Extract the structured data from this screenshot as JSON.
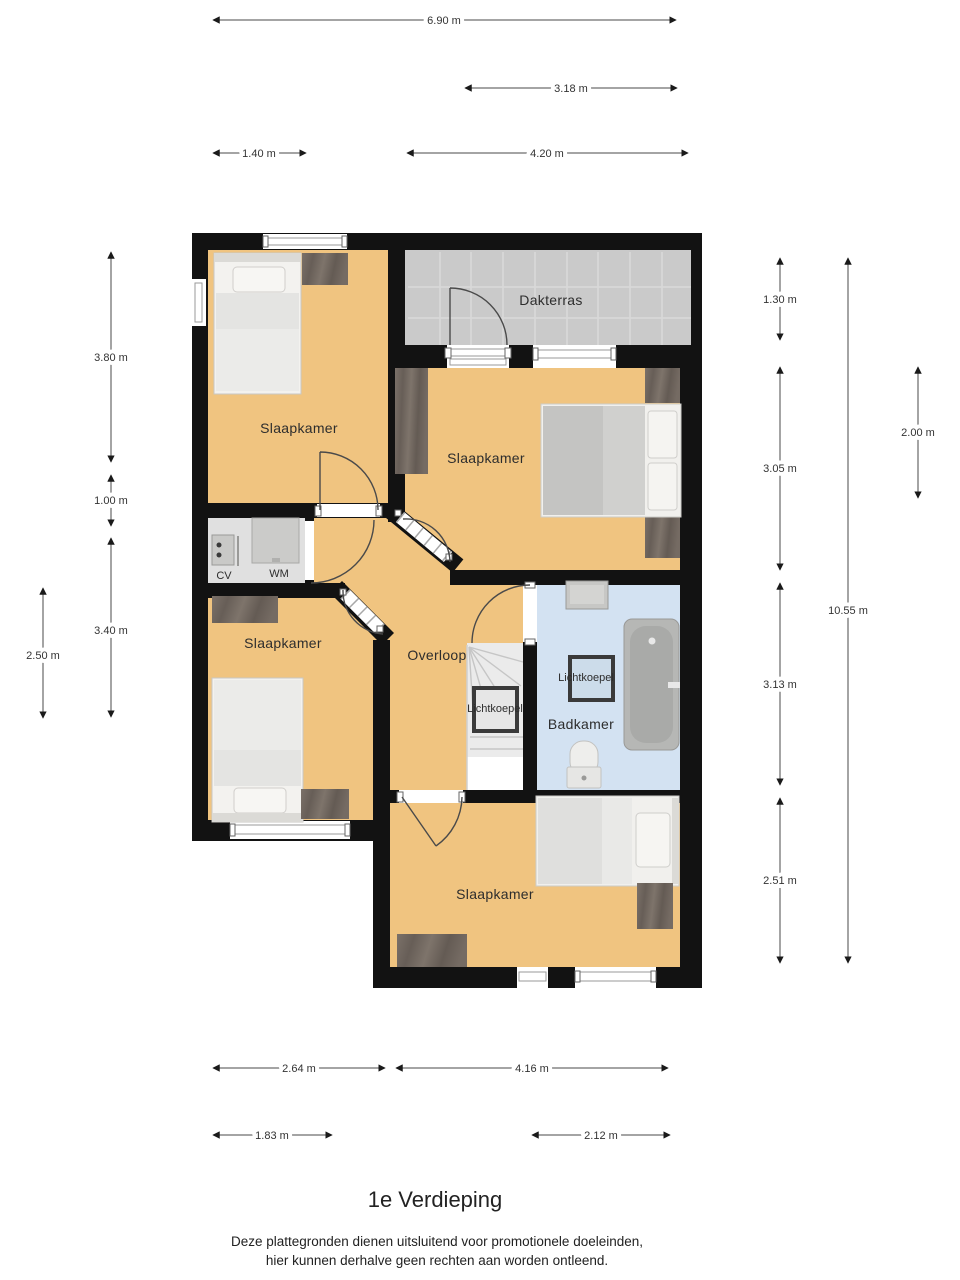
{
  "title": "1e Verdieping",
  "disclaimer": {
    "line1": "Deze plattegronden dienen uitsluitend voor promotionele doeleinden,",
    "line2": "hier kunnen derhalve geen rechten aan worden ontleend."
  },
  "rooms": {
    "bedroom_top_left": "Slaapkamer",
    "terrace": "Dakterras",
    "bedroom_right": "Slaapkamer",
    "bedroom_mid_left": "Slaapkamer",
    "landing": "Overloop",
    "bathroom": "Badkamer",
    "bedroom_bottom": "Slaapkamer",
    "skylight_stairs": "Lichtkoepel",
    "skylight_bathroom": "Lichtkoepel",
    "boiler": "CV",
    "washer": "WM"
  },
  "dimensions": {
    "top": {
      "total": "6.90 m",
      "terrace_width": "3.18 m",
      "seg_left": "1.40 m",
      "seg_right": "4.20 m"
    },
    "left": {
      "bedroom_top": "3.80 m",
      "closet": "1.00 m",
      "bedroom_mid": "3.40 m",
      "inner": "2.50 m"
    },
    "right": {
      "terrace": "1.30 m",
      "bedroom": "3.05 m",
      "bathroom": "3.13 m",
      "bedroom_bottom": "2.51 m",
      "total": "10.55 m",
      "inner": "2.00 m"
    },
    "bottom": {
      "seg_left": "2.64 m",
      "seg_right": "4.16 m",
      "window_left": "1.83 m",
      "window_right": "2.12 m"
    }
  },
  "colors": {
    "floor_orange": "#f0c480",
    "terrace_grey": "#cacaca",
    "bathroom_blue": "#d3e2f2",
    "closet_grey": "#e0e0e0",
    "wall_black": "#121212",
    "wardrobe_brown": "#6f665e"
  }
}
